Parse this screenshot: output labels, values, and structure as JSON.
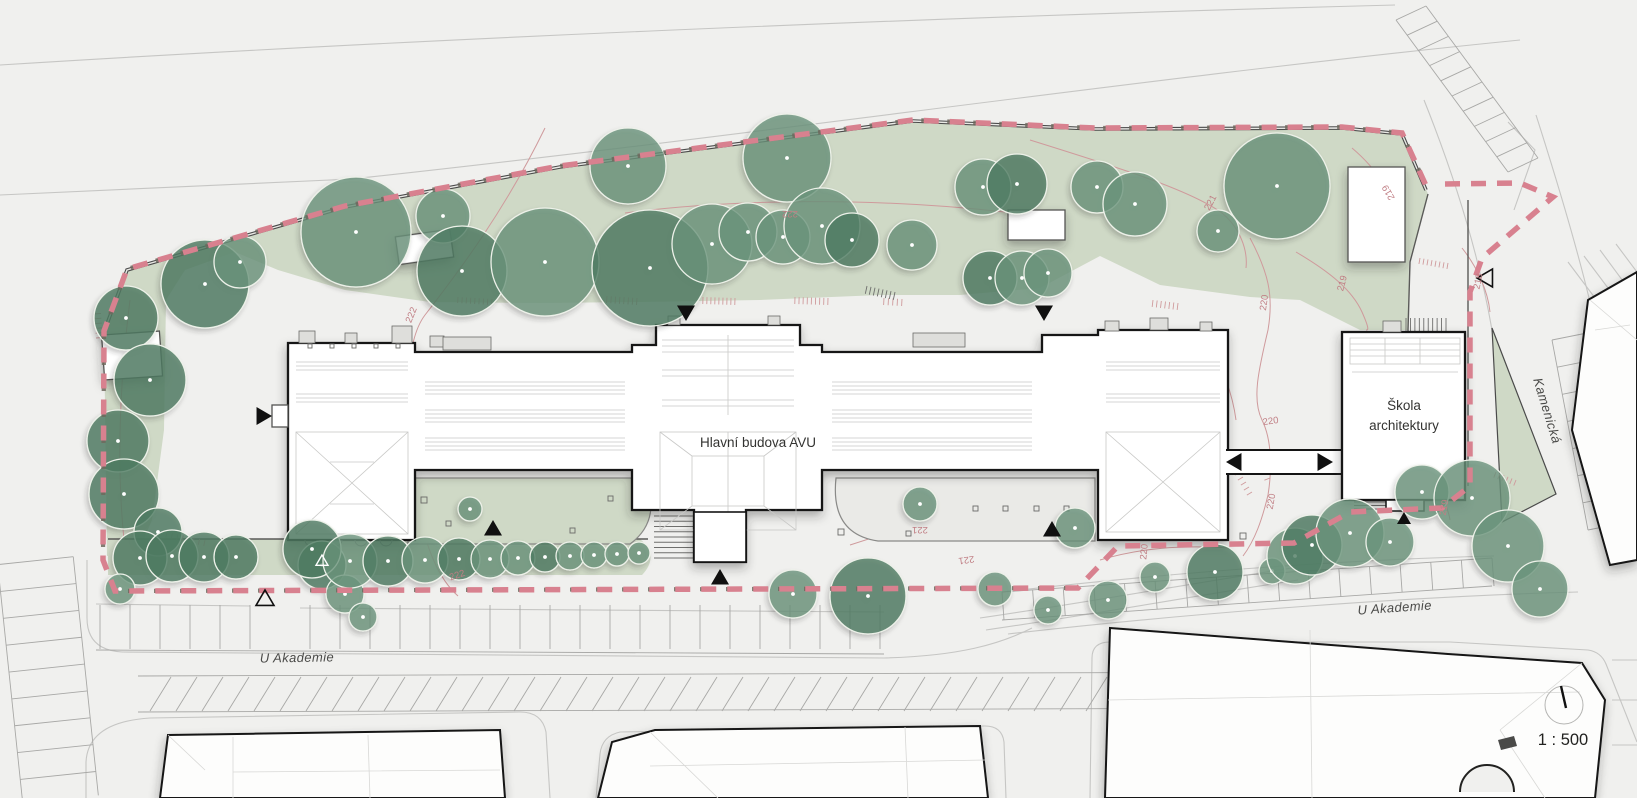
{
  "labels": {
    "main_building": "Hlavní budova AVU",
    "school_line1": "Škola",
    "school_line2": "architektury",
    "street_bottom_left": "U Akademie",
    "street_bottom_right": "U Akademie",
    "street_side": "Kamenická",
    "scale": "1 : 500"
  },
  "colors": {
    "paper": "#f0f0ee",
    "lawn": "#cfd9c6",
    "tree": "#69927a",
    "tree_dark": "#4e7a61",
    "tree_stroke": "#edf1e9",
    "boundary_pink": "#d8818f",
    "boundary_khaki": "#6f695d",
    "contour": "#cf9a9c",
    "ink": "#141414",
    "road": "#c6c6c4",
    "wall": "#4a4a4a"
  },
  "contour_labels": [
    {
      "t": "222",
      "x": 414,
      "y": 316,
      "r": -68
    },
    {
      "t": "222",
      "x": 790,
      "y": 211,
      "r": 180
    },
    {
      "t": "222",
      "x": 458,
      "y": 578,
      "r": -18
    },
    {
      "t": "221",
      "x": 1213,
      "y": 204,
      "r": -62
    },
    {
      "t": "221",
      "x": 920,
      "y": 527,
      "r": 180
    },
    {
      "t": "221",
      "x": 966,
      "y": 557,
      "r": 172
    },
    {
      "t": "220",
      "x": 1267,
      "y": 303,
      "r": -82
    },
    {
      "t": "220",
      "x": 1271,
      "y": 424,
      "r": -8
    },
    {
      "t": "220",
      "x": 1274,
      "y": 502,
      "r": -80
    },
    {
      "t": "220",
      "x": 1147,
      "y": 552,
      "r": -85
    },
    {
      "t": "219",
      "x": 1391,
      "y": 191,
      "r": -120
    },
    {
      "t": "219",
      "x": 1345,
      "y": 284,
      "r": -75
    },
    {
      "t": "219",
      "x": 1447,
      "y": 508,
      "r": -80
    },
    {
      "t": "218",
      "x": 1481,
      "y": 282,
      "r": -78
    }
  ],
  "trees": [
    [
      126,
      318,
      32,
      1
    ],
    [
      150,
      380,
      36,
      1
    ],
    [
      118,
      441,
      31,
      1
    ],
    [
      124,
      494,
      35,
      1
    ],
    [
      158,
      532,
      24,
      1
    ],
    [
      205,
      284,
      44,
      1
    ],
    [
      240,
      262,
      26,
      0
    ],
    [
      140,
      558,
      27,
      1
    ],
    [
      172,
      556,
      26,
      1
    ],
    [
      204,
      557,
      25,
      1
    ],
    [
      236,
      557,
      22,
      1
    ],
    [
      120,
      589,
      15,
      0
    ],
    [
      322,
      565,
      24,
      1
    ],
    [
      345,
      594,
      19,
      0
    ],
    [
      363,
      617,
      14,
      0
    ],
    [
      356,
      232,
      55,
      0
    ],
    [
      443,
      216,
      27,
      0
    ],
    [
      462,
      271,
      45,
      1
    ],
    [
      545,
      262,
      54,
      0
    ],
    [
      628,
      166,
      38,
      0
    ],
    [
      650,
      268,
      58,
      1
    ],
    [
      712,
      244,
      40,
      0
    ],
    [
      748,
      232,
      29,
      0
    ],
    [
      783,
      237,
      27,
      0
    ],
    [
      787,
      158,
      44,
      0
    ],
    [
      822,
      226,
      38,
      0
    ],
    [
      852,
      240,
      27,
      1
    ],
    [
      912,
      245,
      25,
      0
    ],
    [
      990,
      278,
      27,
      1
    ],
    [
      1022,
      278,
      27,
      0
    ],
    [
      1048,
      273,
      24,
      0
    ],
    [
      983,
      187,
      28,
      0
    ],
    [
      1017,
      184,
      30,
      1
    ],
    [
      1097,
      187,
      26,
      0
    ],
    [
      1135,
      204,
      32,
      0
    ],
    [
      1218,
      231,
      21,
      0
    ],
    [
      1277,
      186,
      53,
      0
    ],
    [
      312,
      549,
      29,
      1
    ],
    [
      350,
      561,
      27,
      0
    ],
    [
      388,
      561,
      25,
      1
    ],
    [
      425,
      560,
      23,
      0
    ],
    [
      459,
      559,
      21,
      1
    ],
    [
      490,
      559,
      19,
      0
    ],
    [
      518,
      558,
      17,
      0
    ],
    [
      545,
      557,
      15,
      1
    ],
    [
      570,
      556,
      14,
      0
    ],
    [
      594,
      555,
      13,
      0
    ],
    [
      617,
      554,
      12,
      0
    ],
    [
      639,
      553,
      11,
      0
    ],
    [
      470,
      509,
      12,
      0
    ],
    [
      793,
      594,
      24,
      0
    ],
    [
      868,
      596,
      38,
      1
    ],
    [
      920,
      504,
      17,
      0
    ],
    [
      995,
      589,
      17,
      0
    ],
    [
      1048,
      610,
      14,
      0
    ],
    [
      1075,
      528,
      20,
      0
    ],
    [
      1108,
      600,
      19,
      0
    ],
    [
      1155,
      577,
      15,
      0
    ],
    [
      1215,
      572,
      28,
      1
    ],
    [
      1272,
      571,
      13,
      0
    ],
    [
      1295,
      556,
      28,
      0
    ],
    [
      1312,
      545,
      30,
      1
    ],
    [
      1350,
      533,
      34,
      0
    ],
    [
      1390,
      542,
      24,
      0
    ],
    [
      1422,
      492,
      27,
      0
    ],
    [
      1472,
      498,
      38,
      0
    ],
    [
      1508,
      546,
      36,
      0
    ],
    [
      1540,
      589,
      28,
      0
    ]
  ],
  "markers": {
    "filled": [
      {
        "x": 263,
        "y": 416,
        "dir": "right"
      },
      {
        "x": 686,
        "y": 312,
        "dir": "down"
      },
      {
        "x": 1044,
        "y": 312,
        "dir": "down"
      },
      {
        "x": 493,
        "y": 529,
        "dir": "up"
      },
      {
        "x": 720,
        "y": 578,
        "dir": "up"
      },
      {
        "x": 1052,
        "y": 530,
        "dir": "up"
      },
      {
        "x": 1235,
        "y": 462,
        "dir": "left"
      },
      {
        "x": 1324,
        "y": 462,
        "dir": "right"
      },
      {
        "x": 1404,
        "y": 519,
        "dir": "up",
        "s": 7
      }
    ],
    "open": [
      {
        "x": 265,
        "y": 599,
        "dir": "up"
      },
      {
        "x": 1486,
        "y": 278,
        "dir": "left"
      },
      {
        "x": 322,
        "y": 561,
        "dir": "up",
        "s": 6,
        "white": true
      }
    ]
  },
  "ticks": [
    {
      "x1": 607,
      "y1": 296,
      "x2": 637,
      "y2": 298,
      "n": 8,
      "len": 7
    },
    {
      "x1": 703,
      "y1": 297,
      "x2": 735,
      "y2": 298,
      "n": 9,
      "len": 7
    },
    {
      "x1": 795,
      "y1": 297,
      "x2": 828,
      "y2": 298,
      "n": 9,
      "len": 7
    },
    {
      "x1": 884,
      "y1": 298,
      "x2": 902,
      "y2": 299,
      "n": 5,
      "len": 7
    },
    {
      "x1": 1153,
      "y1": 300,
      "x2": 1178,
      "y2": 303,
      "n": 7,
      "len": 7
    },
    {
      "x1": 94,
      "y1": 314,
      "x2": 96,
      "y2": 338,
      "n": 6,
      "len": -7
    },
    {
      "x1": 1420,
      "y1": 258,
      "x2": 1448,
      "y2": 263,
      "n": 8,
      "len": 6
    },
    {
      "x1": 458,
      "y1": 297,
      "x2": 492,
      "y2": 299,
      "n": 9,
      "len": 6
    },
    {
      "x1": 1240,
      "y1": 472,
      "x2": 1252,
      "y2": 492,
      "n": 5,
      "len": 6
    },
    {
      "x1": 1262,
      "y1": 458,
      "x2": 1270,
      "y2": 478,
      "n": 4,
      "len": 6
    },
    {
      "x1": 1496,
      "y1": 472,
      "x2": 1516,
      "y2": 480,
      "n": 6,
      "len": 6
    },
    {
      "x1": 167,
      "y1": 532,
      "x2": 205,
      "y2": 540,
      "n": 8,
      "len": 6
    },
    {
      "x1": 867,
      "y1": 286,
      "x2": 895,
      "y2": 292,
      "n": 8,
      "len": 8,
      "c": "dark"
    },
    {
      "x1": 445,
      "y1": 339,
      "x2": 489,
      "y2": 339,
      "n": 11,
      "len": 9,
      "c": "dark"
    },
    {
      "x1": 915,
      "y1": 335,
      "x2": 963,
      "y2": 335,
      "n": 12,
      "len": 11,
      "c": "dark"
    },
    {
      "x1": 1406,
      "y1": 318,
      "x2": 1446,
      "y2": 318,
      "n": 10,
      "len": 13,
      "c": "dark"
    },
    {
      "x1": 1046,
      "y1": 506,
      "x2": 1046,
      "y2": 522,
      "n": 5,
      "len": 16,
      "c": "dark"
    },
    {
      "x1": 482,
      "y1": 506,
      "x2": 482,
      "y2": 520,
      "n": 5,
      "len": 18,
      "c": "dark"
    },
    {
      "x1": 698,
      "y1": 516,
      "x2": 698,
      "y2": 558,
      "n": 9,
      "len": 44,
      "c": "dark"
    },
    {
      "x1": 1388,
      "y1": 502,
      "x2": 1388,
      "y2": 509,
      "n": 3,
      "len": 34,
      "c": "dark"
    }
  ]
}
